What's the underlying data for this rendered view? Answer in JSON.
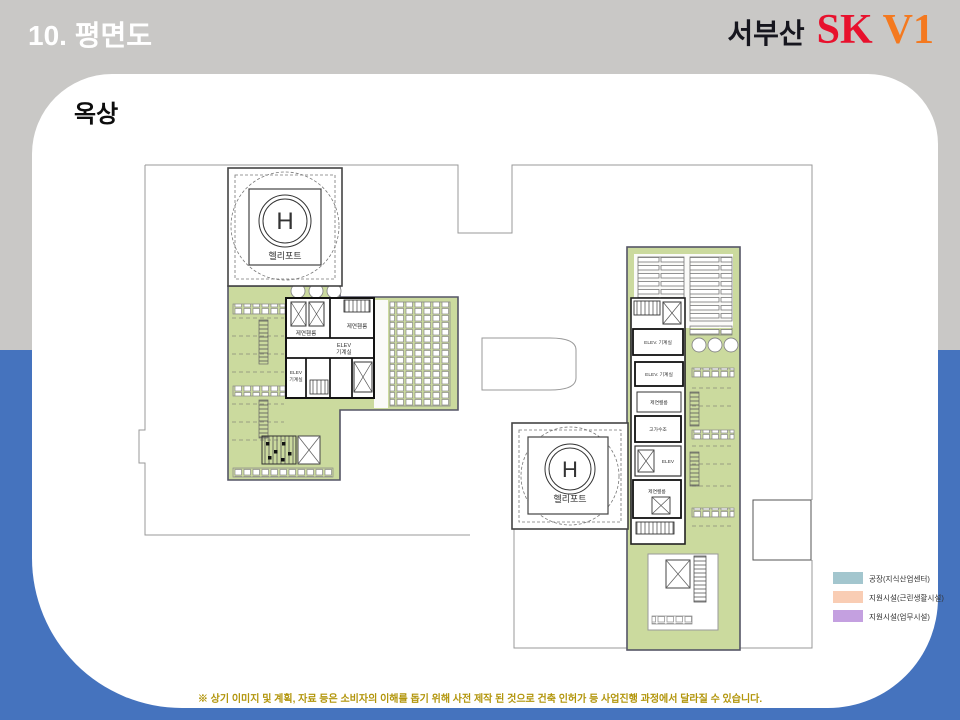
{
  "header": {
    "title": "10. 평면도",
    "brand": {
      "location": "서부산",
      "sk": "SK",
      "v1": "V1"
    }
  },
  "content": {
    "section_label": "옥상"
  },
  "plan": {
    "heliport_left": {
      "symbol": "H",
      "label": "헬리포트"
    },
    "heliport_right": {
      "symbol": "H",
      "label": "헬리포트"
    },
    "left_core": {
      "smoke_room_1": "제연휀룸",
      "smoke_room_2": "제연휀룸",
      "elev1_line1": "ELEV",
      "elev1_line2": "기계실",
      "elev2_line1": "ELEV",
      "elev2_line2": "기계실"
    },
    "right_core": {
      "elev_machine_1": "ELEV. 기계실",
      "elev_machine_2": "ELEV. 기계실",
      "smoke_room_1": "제연휀룸",
      "water_tank": "고가수조",
      "elev_small": "ELEV",
      "smoke_room_2": "제연휀룸"
    }
  },
  "legend": {
    "items": [
      {
        "color": "#A3C6CE",
        "label": "공장(지식산업센터)"
      },
      {
        "color": "#F9CDB4",
        "label": "지원시설(근린생활시설)"
      },
      {
        "color": "#C4A0E0",
        "label": "지원시설(업무시설)"
      }
    ]
  },
  "footer": {
    "disclaimer": "※ 상기 이미지 및 계획, 자료 등은 소비자의 이해를 돕기 위해 사전 제작 된 것으로 건축 인허가 등 사업진행 과정에서 달라질 수 있습니다."
  },
  "colors": {
    "slide_top": "#C9C8C6",
    "slide_bottom": "#4573BE",
    "plan_green": "#CBDA9E",
    "sk_red": "#E8112D",
    "v1_orange": "#F4791F",
    "disclaimer_gold": "#B2950B"
  }
}
